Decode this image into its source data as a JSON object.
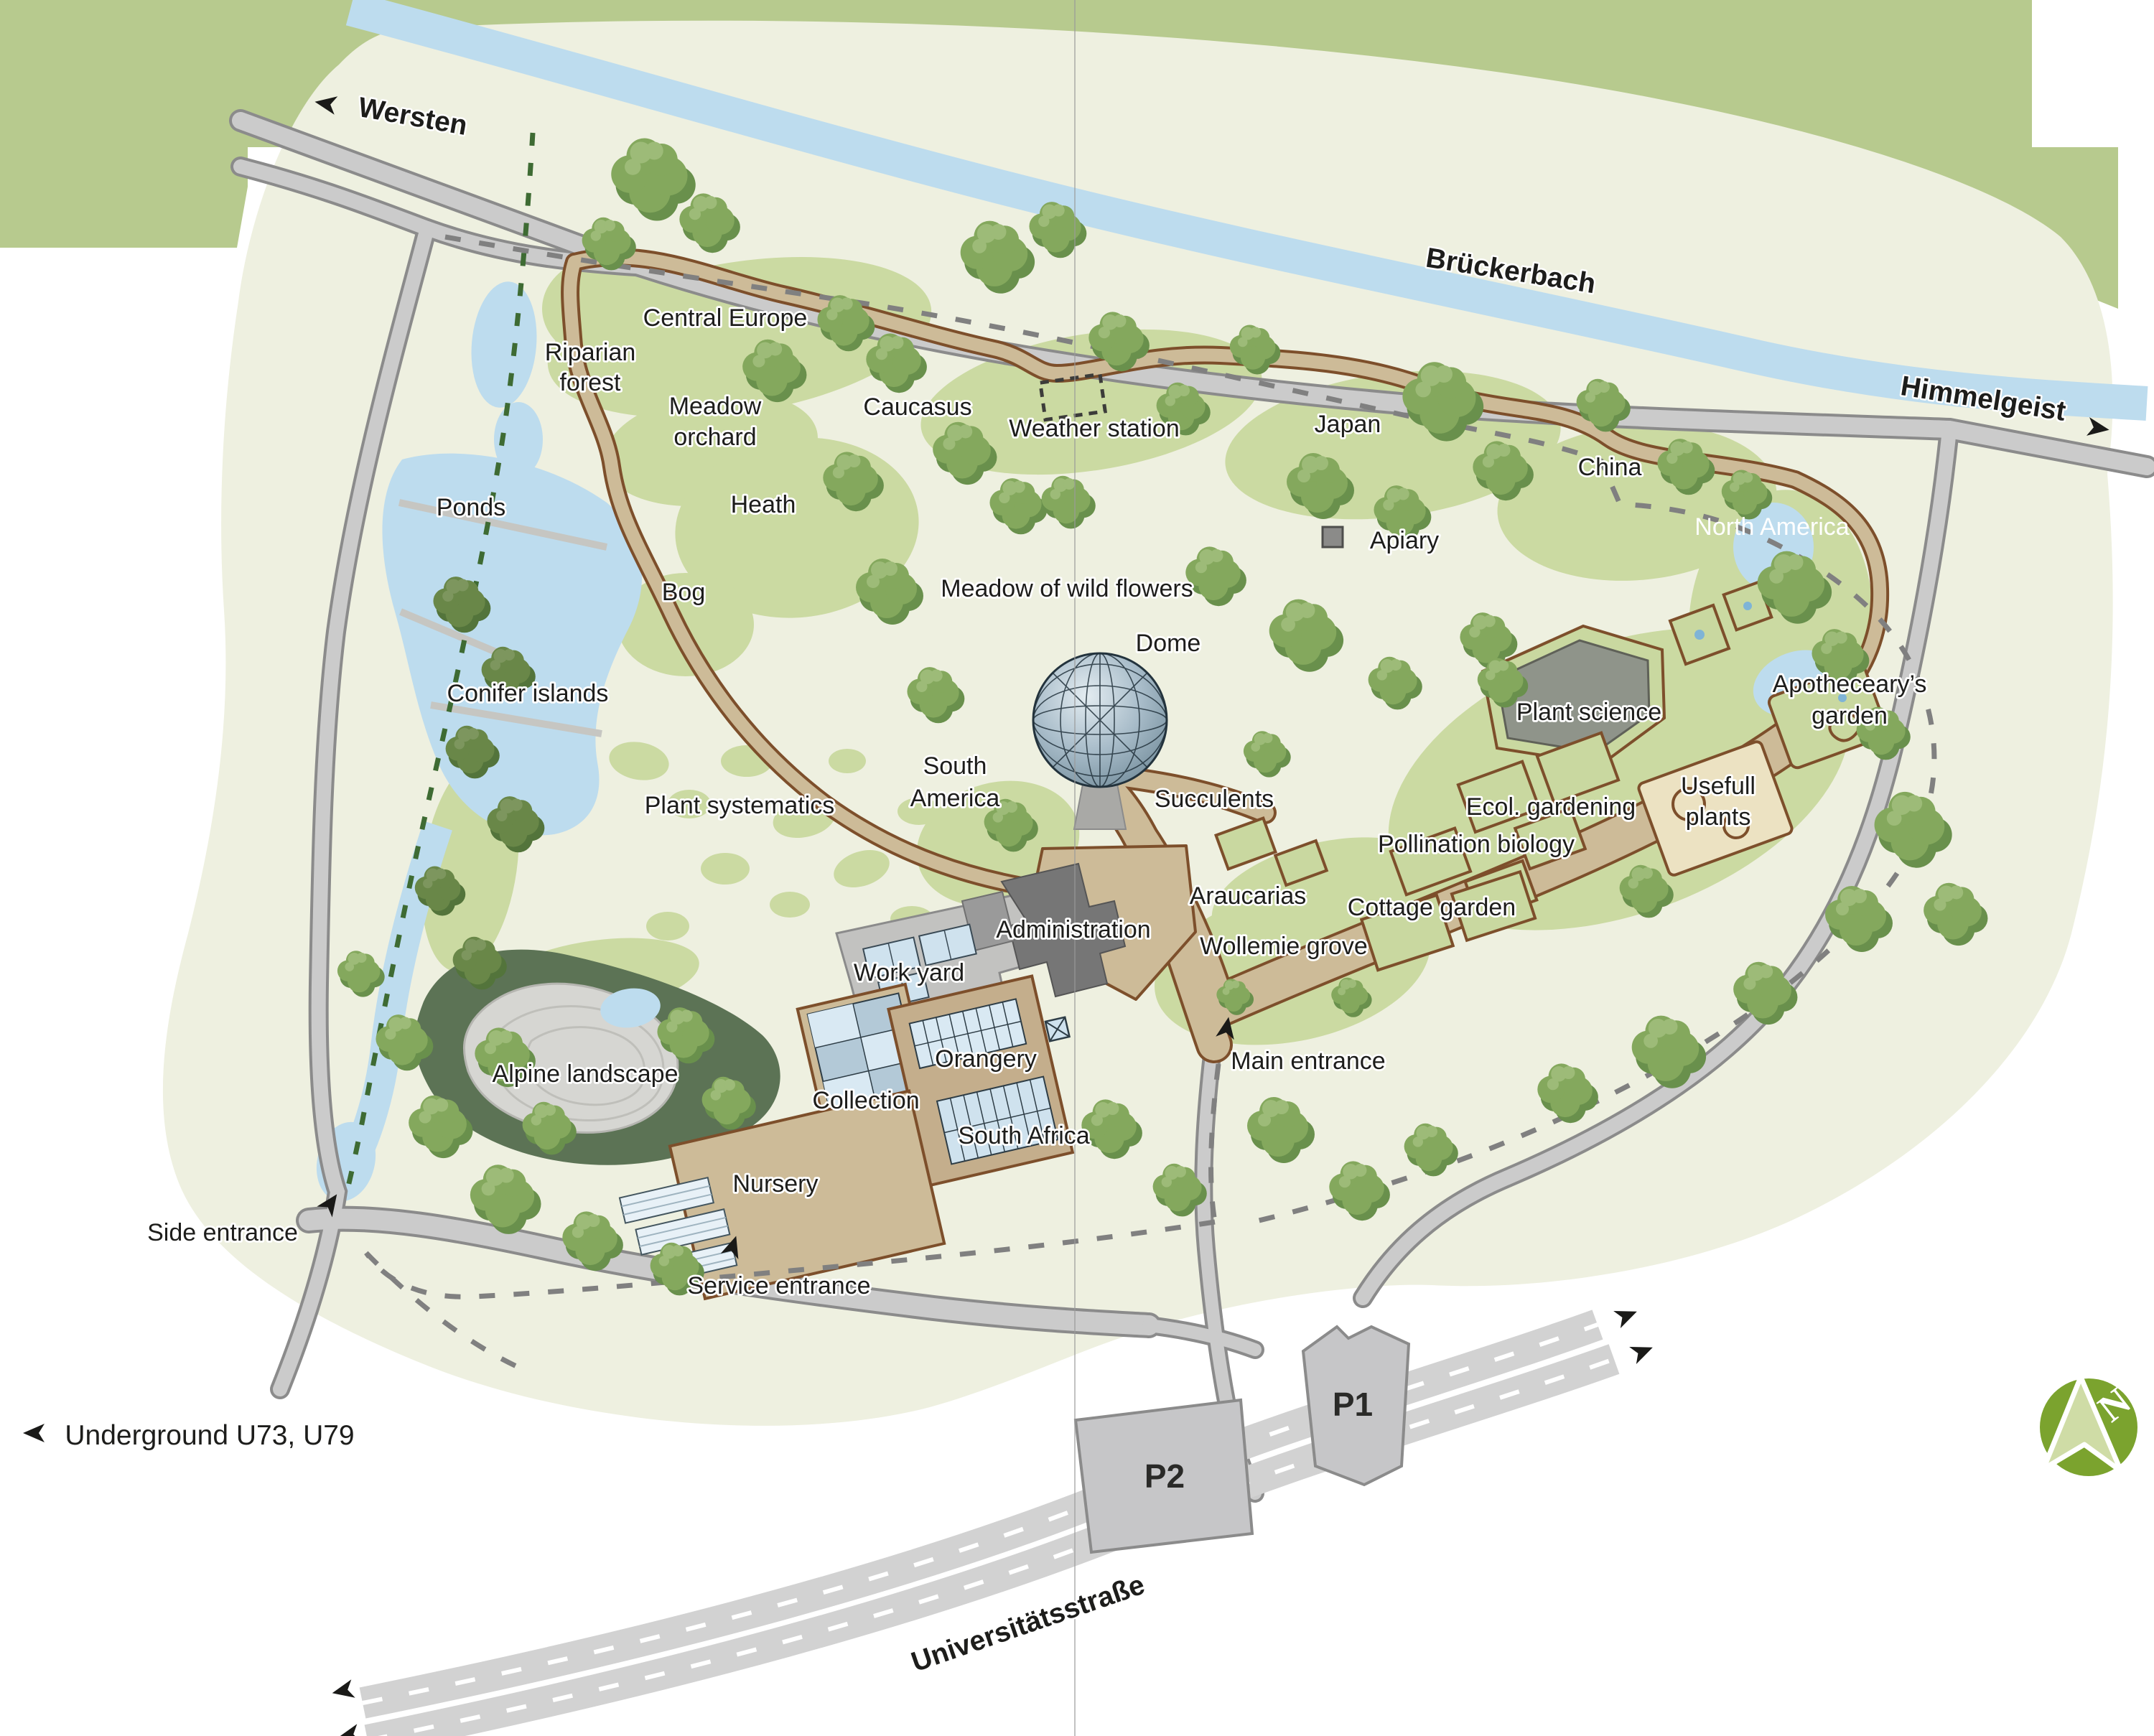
{
  "map": {
    "kind": "botanical-garden-visitor-map",
    "compass_letter": "N"
  },
  "offsite": {
    "river": "Brückerbach",
    "street": "Universitätsstraße",
    "direction_west": "Wersten",
    "direction_east": "Himmelgeist",
    "underground": "Underground U73, U79",
    "parking_p1": "P1",
    "parking_p2": "P2"
  },
  "entrances": {
    "main": "Main entrance",
    "side": "Side entrance",
    "service": "Service entrance"
  },
  "areas": {
    "central_europe": "Central Europe",
    "riparian_forest_line1": "Riparian",
    "riparian_forest_line2": "forest",
    "meadow_orchard_line1": "Meadow",
    "meadow_orchard_line2": "orchard",
    "caucasus": "Caucasus",
    "weather_station": "Weather station",
    "japan": "Japan",
    "china": "China",
    "north_america": "North America",
    "ponds": "Ponds",
    "heath": "Heath",
    "bog": "Bog",
    "apiary": "Apiary",
    "meadow_of_wild_flowers": "Meadow of wild flowers",
    "dome": "Dome",
    "conifer_islands": "Conifer islands",
    "apothecearys_garden_line1": "Apotheceary’s",
    "apothecearys_garden_line2": "garden",
    "plant_science": "Plant science",
    "south_america_line1": "South",
    "south_america_line2": "America",
    "succulents": "Succulents",
    "ecol_gardening": "Ecol. gardening",
    "usefull_plants_line1": "Usefull",
    "usefull_plants_line2": "plants",
    "pollination_biology": "Pollination biology",
    "plant_systematics": "Plant systematics",
    "araucarias": "Araucarias",
    "cottage_garden": "Cottage garden",
    "administration": "Administration",
    "wollemie_grove": "Wollemie grove",
    "work_yard": "Work yard",
    "alpine_landscape": "Alpine landscape",
    "orangery": "Orangery",
    "collection": "Collection",
    "south_africa": "South Africa",
    "nursery": "Nursery"
  },
  "colors": {
    "page_bg": "#ffffff",
    "terrain": "#eef0e0",
    "offmap_green": "#b7ca8e",
    "water": "#bddcee",
    "tree_green": "#84a85d",
    "lawn_green": "#cbdaa2",
    "path_fill": "#cdbb98",
    "path_edge": "#7d4f2b",
    "road_fill": "#cbcbcb",
    "road_edge": "#8b8b8b",
    "building_gray": "#7e7e7e",
    "glass_blue": "#d9e9f3",
    "conifer_bed": "#5c7355",
    "compass_green": "#7ba32e",
    "boundary_dash": "#808080",
    "green_dash": "#3e6b33"
  }
}
